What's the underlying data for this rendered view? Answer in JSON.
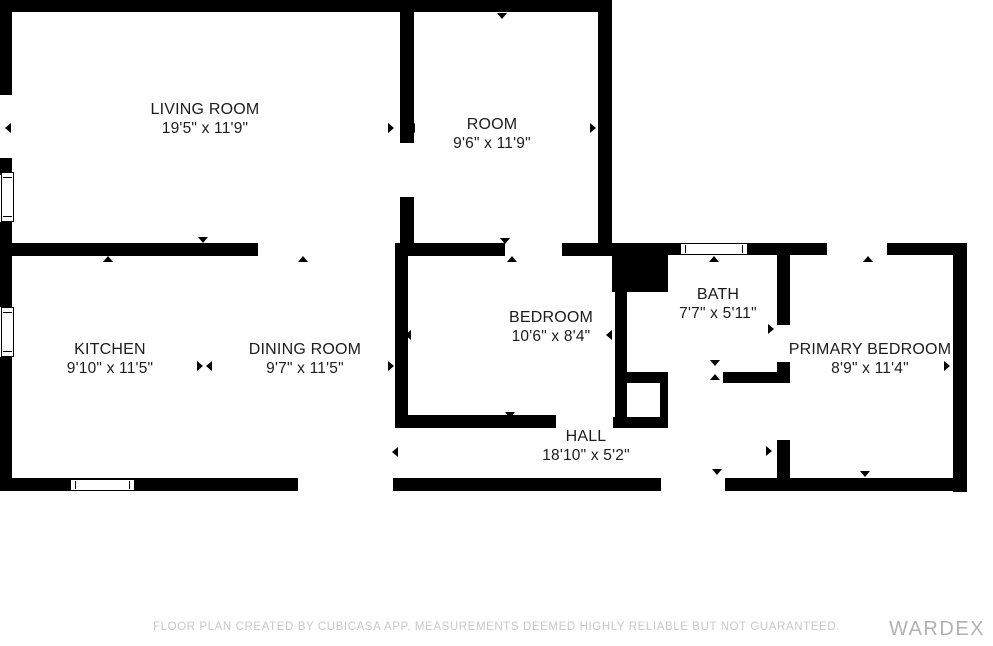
{
  "plan": {
    "rooms": [
      {
        "id": "living-room",
        "name": "LIVING ROOM",
        "dims": "19'5\" x 11'9\""
      },
      {
        "id": "room",
        "name": "ROOM",
        "dims": "9'6\" x 11'9\""
      },
      {
        "id": "kitchen",
        "name": "KITCHEN",
        "dims": "9'10\" x 11'5\""
      },
      {
        "id": "dining-room",
        "name": "DINING ROOM",
        "dims": "9'7\" x 11'5\""
      },
      {
        "id": "bedroom",
        "name": "BEDROOM",
        "dims": "10'6\" x 8'4\""
      },
      {
        "id": "bath",
        "name": "BATH",
        "dims": "7'7\" x 5'11\""
      },
      {
        "id": "primary-bedroom",
        "name": "PRIMARY BEDROOM",
        "dims": "8'9\" x 11'4\""
      },
      {
        "id": "hall",
        "name": "HALL",
        "dims": "18'10\" x 5'2\""
      }
    ],
    "footer": {
      "disclaimer": "FLOOR PLAN CREATED BY CUBICASA APP. MEASUREMENTS DEEMED HIGHLY RELIABLE BUT NOT GUARANTEED.",
      "watermark": "WARDEX"
    },
    "colors": {
      "wall": "#000000",
      "background": "#ffffff",
      "disclaimer_text": "#c8c8c8",
      "watermark_text": "#b2b2b2"
    }
  }
}
